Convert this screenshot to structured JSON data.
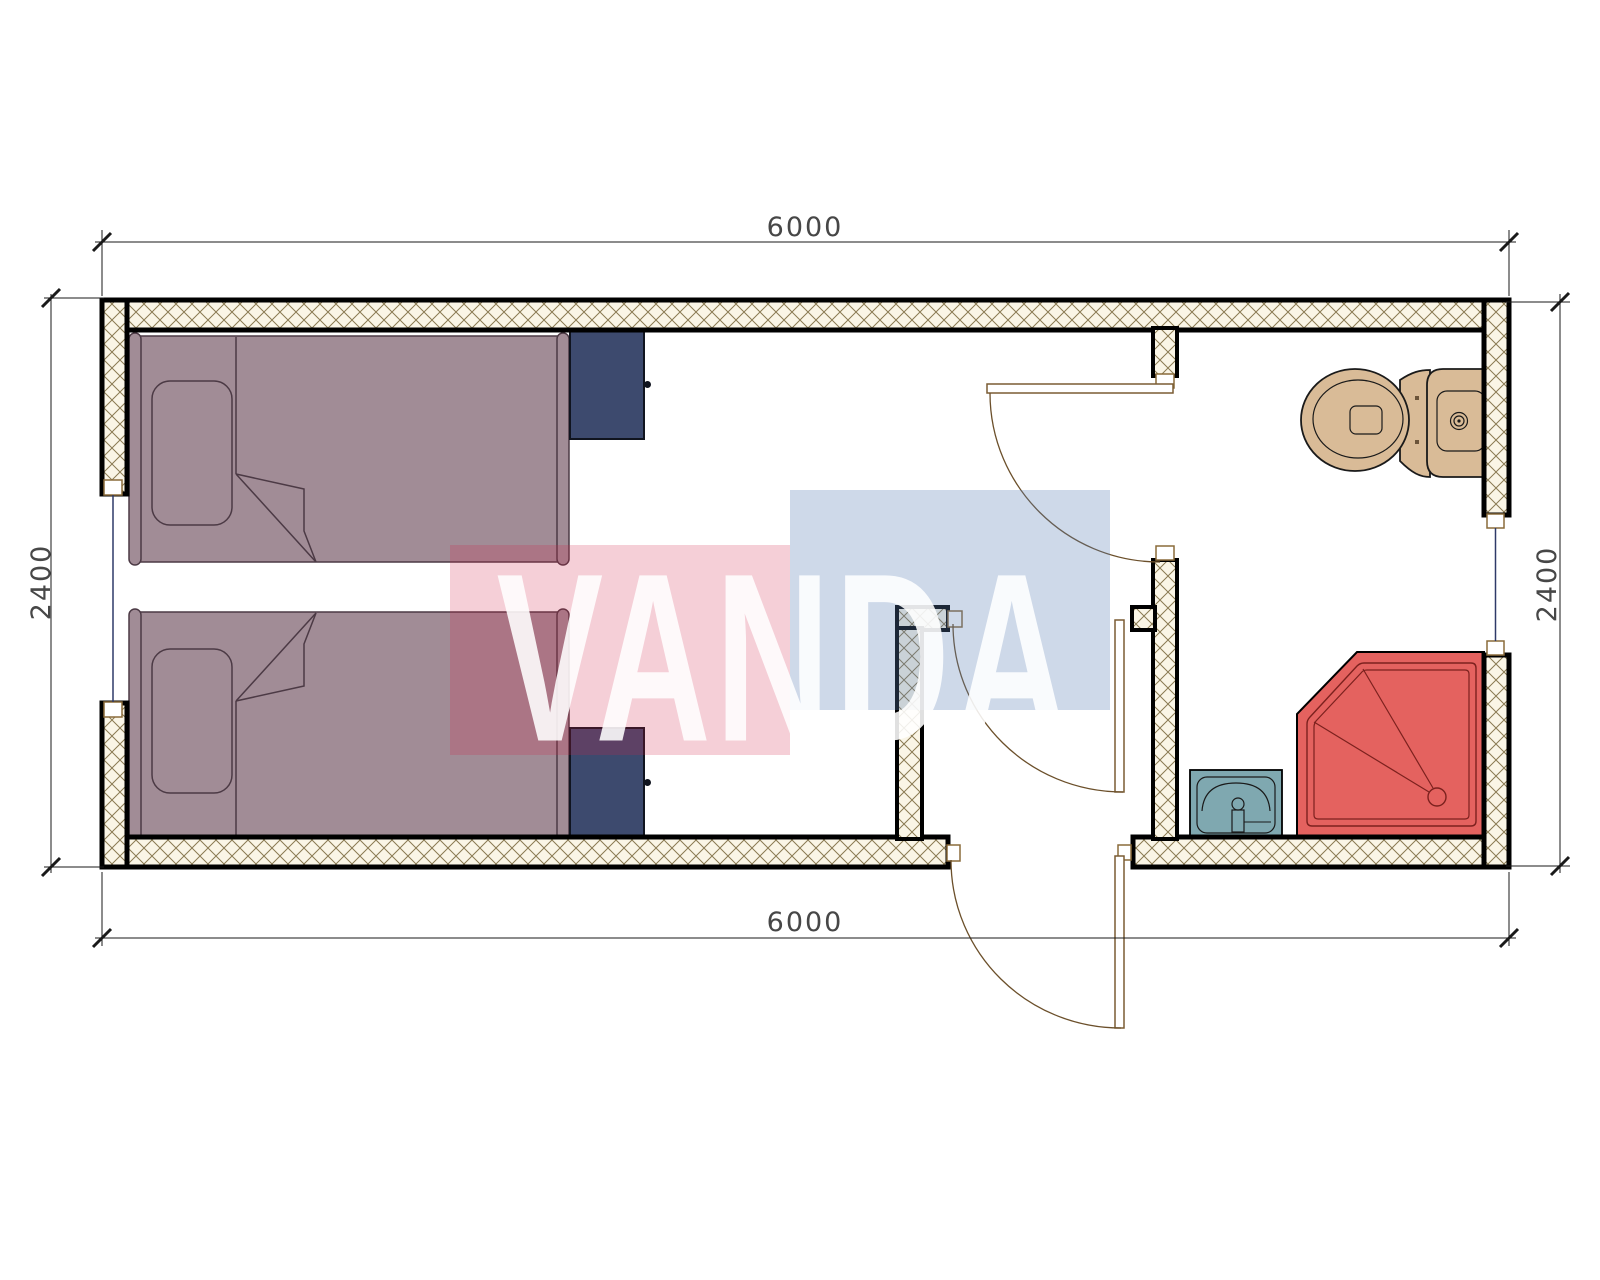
{
  "watermark": {
    "text": "VANDA",
    "red_color": "rgba(211,38,72,0.22)",
    "blue_color": "rgba(92,130,182,0.30)",
    "text_color": "#ffffff"
  },
  "dimensions": {
    "top": "6000",
    "bottom": "6000",
    "left": "2400",
    "right": "2400"
  },
  "palette": {
    "wall_fill": "#faf5e6",
    "wall_hatch_line": "#8a7a52",
    "wall_border": "#000000",
    "bed": "#a18c96",
    "bed_outline": "#4c3a45",
    "nightstand": "#3d4a6e",
    "toilet": "#d9bb97",
    "shower": "#e4625f",
    "shower_detail": "#7c211e",
    "sink": "#7fa8b0",
    "door_line": "#7a5c33",
    "window_glass": "#2e3a68",
    "dimension_line": "#1a1a1a",
    "dimension_text": "#474747"
  },
  "fixtures": {
    "bed1": "single-bed",
    "bed2": "single-bed",
    "nightstand1": "nightstand",
    "nightstand2": "nightstand",
    "toilet": "toilet",
    "shower": "corner-shower-tray",
    "sink": "wash-basin",
    "door_entry": "entry-door-swing",
    "door_corridor": "corridor-door-swing",
    "door_bathroom": "bathroom-door-swing",
    "window_left": "window",
    "window_right": "window"
  }
}
